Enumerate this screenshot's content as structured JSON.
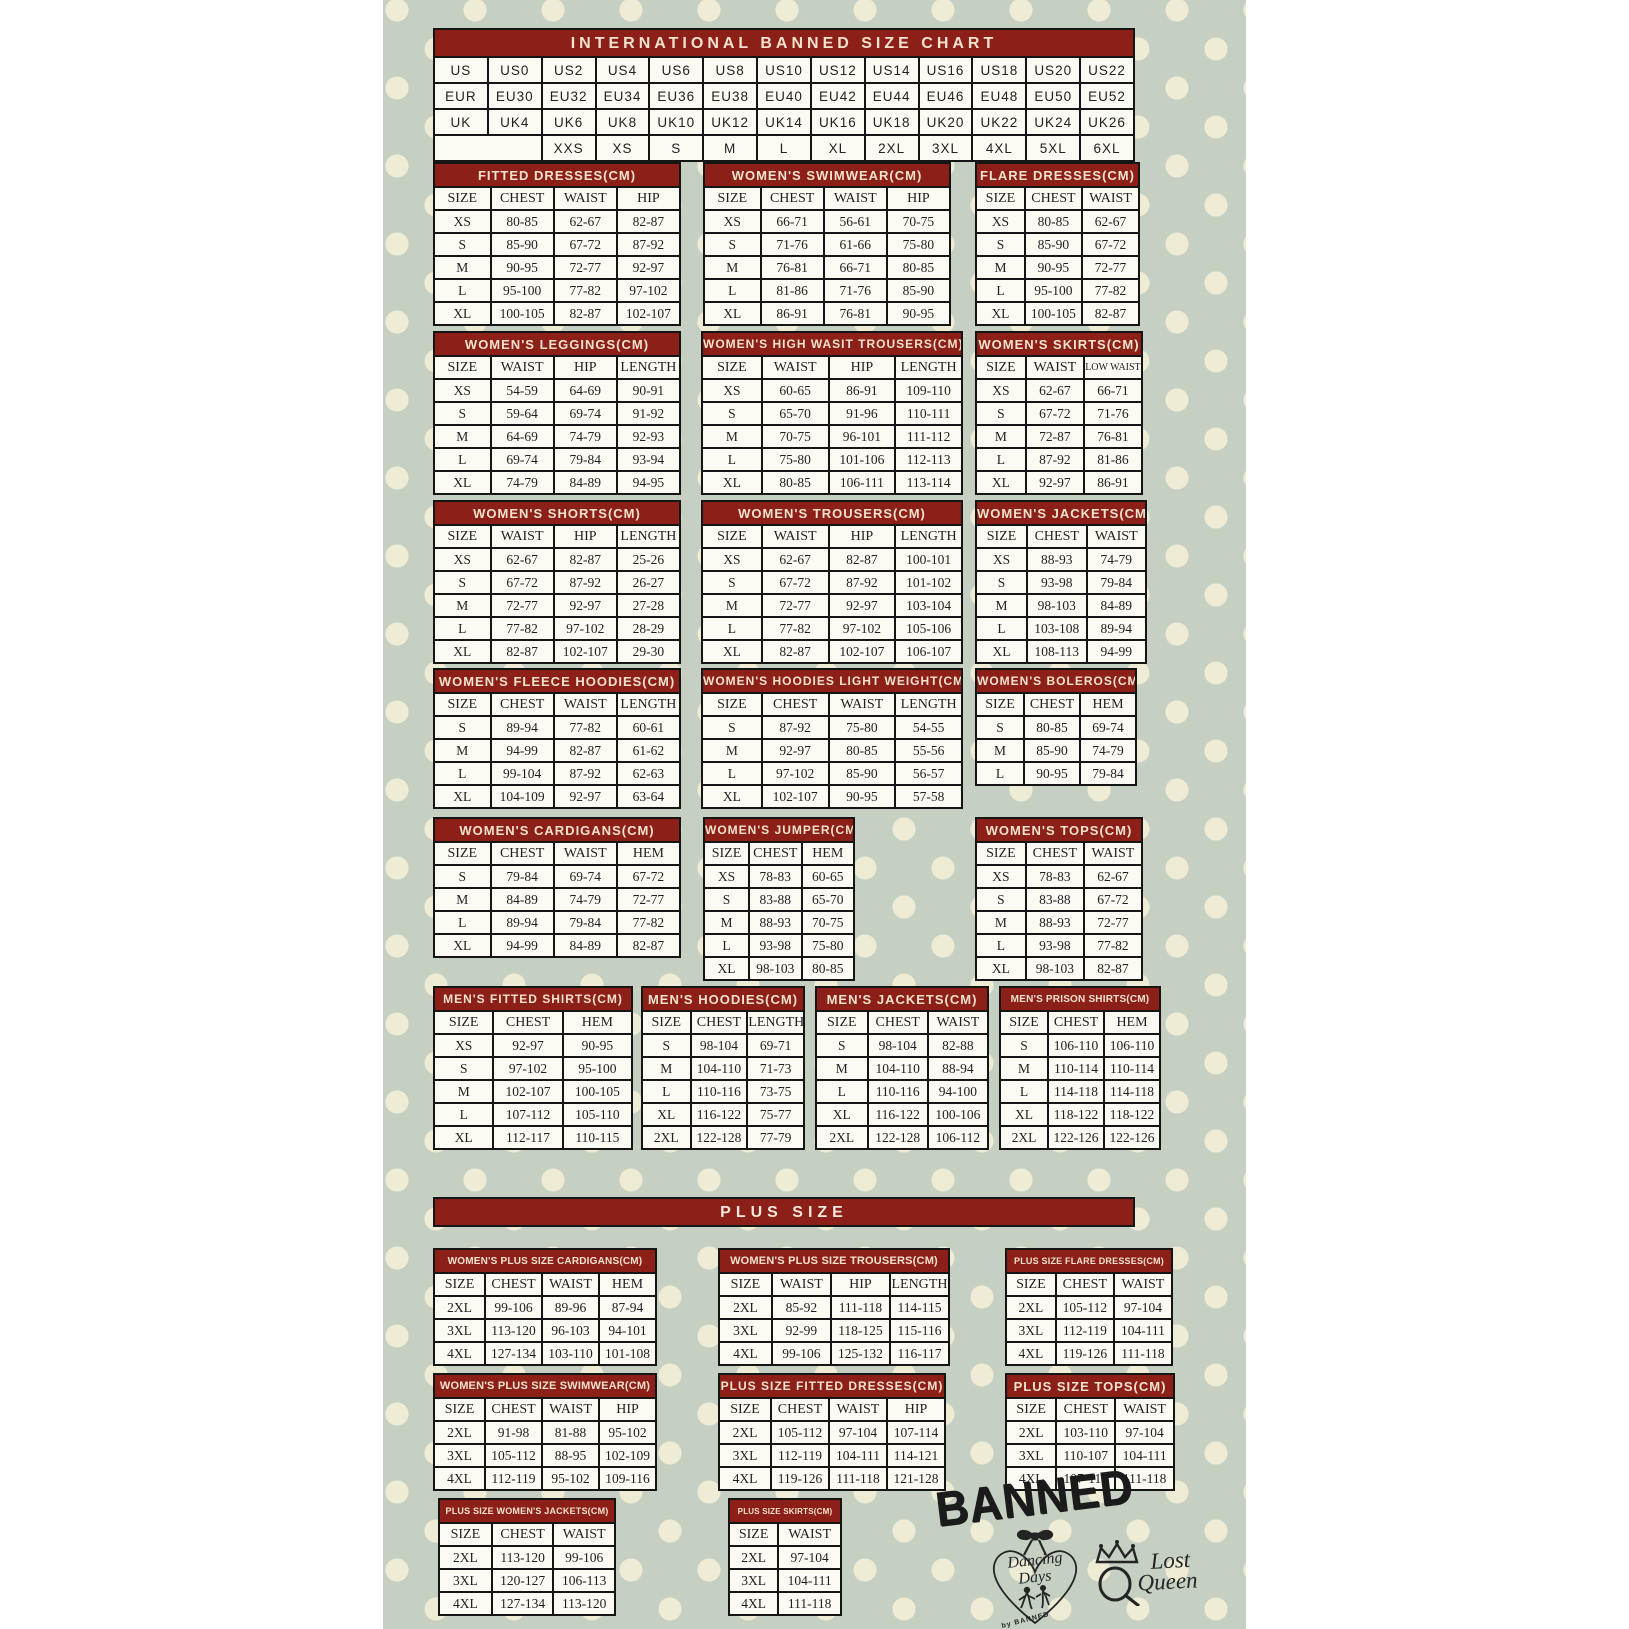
{
  "plus_size_header": "PLUS SIZE",
  "colors": {
    "table_header_red": "#8c1f18",
    "header_text_cream": "#f3e3cd",
    "background_sage": "#c5d0c3",
    "polka_dot_cream": "#efecd6",
    "cell_background": "#fbfaf3",
    "border_black": "#151515",
    "logo_ink": "#242424"
  },
  "conversion_chart": {
    "title": "INTERNATIONAL BANNED SIZE CHART",
    "rows": [
      [
        "US",
        "US0",
        "US2",
        "US4",
        "US6",
        "US8",
        "US10",
        "US12",
        "US14",
        "US16",
        "US18",
        "US20",
        "US22"
      ],
      [
        "EUR",
        "EU30",
        "EU32",
        "EU34",
        "EU36",
        "EU38",
        "EU40",
        "EU42",
        "EU44",
        "EU46",
        "EU48",
        "EU50",
        "EU52"
      ],
      [
        "UK",
        "UK4",
        "UK6",
        "UK8",
        "UK10",
        "UK12",
        "UK14",
        "UK16",
        "UK18",
        "UK20",
        "UK22",
        "UK24",
        "UK26"
      ],
      [
        {
          "text": "",
          "span": 2
        },
        "XXS",
        "XS",
        "S",
        "M",
        "L",
        "XL",
        "2XL",
        "3XL",
        "4XL",
        "5XL",
        "6XL"
      ]
    ]
  },
  "size_tables": {
    "fitted_dresses": {
      "title": "FITTED DRESSES(CM)",
      "headers": [
        "SIZE",
        "CHEST",
        "WAIST",
        "HIP"
      ],
      "rows": [
        [
          "XS",
          "80-85",
          "62-67",
          "82-87"
        ],
        [
          "S",
          "85-90",
          "67-72",
          "87-92"
        ],
        [
          "M",
          "90-95",
          "72-77",
          "92-97"
        ],
        [
          "L",
          "95-100",
          "77-82",
          "97-102"
        ],
        [
          "XL",
          "100-105",
          "82-87",
          "102-107"
        ]
      ]
    },
    "womens_swimwear": {
      "title": "WOMEN'S SWIMWEAR(CM)",
      "headers": [
        "SIZE",
        "CHEST",
        "WAIST",
        "HIP"
      ],
      "rows": [
        [
          "XS",
          "66-71",
          "56-61",
          "70-75"
        ],
        [
          "S",
          "71-76",
          "61-66",
          "75-80"
        ],
        [
          "M",
          "76-81",
          "66-71",
          "80-85"
        ],
        [
          "L",
          "81-86",
          "71-76",
          "85-90"
        ],
        [
          "XL",
          "86-91",
          "76-81",
          "90-95"
        ]
      ]
    },
    "flare_dresses": {
      "title": "FLARE DRESSES(CM)",
      "headers": [
        "SIZE",
        "CHEST",
        "WAIST"
      ],
      "rows": [
        [
          "XS",
          "80-85",
          "62-67"
        ],
        [
          "S",
          "85-90",
          "67-72"
        ],
        [
          "M",
          "90-95",
          "72-77"
        ],
        [
          "L",
          "95-100",
          "77-82"
        ],
        [
          "XL",
          "100-105",
          "82-87"
        ]
      ]
    },
    "womens_leggings": {
      "title": "WOMEN'S LEGGINGS(CM)",
      "headers": [
        "SIZE",
        "WAIST",
        "HIP",
        "LENGTH"
      ],
      "rows": [
        [
          "XS",
          "54-59",
          "64-69",
          "90-91"
        ],
        [
          "S",
          "59-64",
          "69-74",
          "91-92"
        ],
        [
          "M",
          "64-69",
          "74-79",
          "92-93"
        ],
        [
          "L",
          "69-74",
          "79-84",
          "93-94"
        ],
        [
          "XL",
          "74-79",
          "84-89",
          "94-95"
        ]
      ]
    },
    "womens_high_wasit_trousers": {
      "title": "WOMEN'S HIGH WASIT TROUSERS(CM)",
      "headers": [
        "SIZE",
        "WAIST",
        "HIP",
        "LENGTH"
      ],
      "rows": [
        [
          "XS",
          "60-65",
          "86-91",
          "109-110"
        ],
        [
          "S",
          "65-70",
          "91-96",
          "110-111"
        ],
        [
          "M",
          "70-75",
          "96-101",
          "111-112"
        ],
        [
          "L",
          "75-80",
          "101-106",
          "112-113"
        ],
        [
          "XL",
          "80-85",
          "106-111",
          "113-114"
        ]
      ]
    },
    "womens_skirts": {
      "title": "WOMEN'S SKIRTS(CM)",
      "headers": [
        "SIZE",
        "WAIST",
        "LOW WAIST"
      ],
      "rows": [
        [
          "XS",
          "62-67",
          "66-71"
        ],
        [
          "S",
          "67-72",
          "71-76"
        ],
        [
          "M",
          "72-87",
          "76-81"
        ],
        [
          "L",
          "87-92",
          "81-86"
        ],
        [
          "XL",
          "92-97",
          "86-91"
        ]
      ]
    },
    "womens_shorts": {
      "title": "WOMEN'S SHORTS(CM)",
      "headers": [
        "SIZE",
        "WAIST",
        "HIP",
        "LENGTH"
      ],
      "rows": [
        [
          "XS",
          "62-67",
          "82-87",
          "25-26"
        ],
        [
          "S",
          "67-72",
          "87-92",
          "26-27"
        ],
        [
          "M",
          "72-77",
          "92-97",
          "27-28"
        ],
        [
          "L",
          "77-82",
          "97-102",
          "28-29"
        ],
        [
          "XL",
          "82-87",
          "102-107",
          "29-30"
        ]
      ]
    },
    "womens_trousers": {
      "title": "WOMEN'S TROUSERS(CM)",
      "headers": [
        "SIZE",
        "WAIST",
        "HIP",
        "LENGTH"
      ],
      "rows": [
        [
          "XS",
          "62-67",
          "82-87",
          "100-101"
        ],
        [
          "S",
          "67-72",
          "87-92",
          "101-102"
        ],
        [
          "M",
          "72-77",
          "92-97",
          "103-104"
        ],
        [
          "L",
          "77-82",
          "97-102",
          "105-106"
        ],
        [
          "XL",
          "82-87",
          "102-107",
          "106-107"
        ]
      ]
    },
    "womens_jackets": {
      "title": "WOMEN'S JACKETS(CM)",
      "headers": [
        "SIZE",
        "CHEST",
        "WAIST"
      ],
      "rows": [
        [
          "XS",
          "88-93",
          "74-79"
        ],
        [
          "S",
          "93-98",
          "79-84"
        ],
        [
          "M",
          "98-103",
          "84-89"
        ],
        [
          "L",
          "103-108",
          "89-94"
        ],
        [
          "XL",
          "108-113",
          "94-99"
        ]
      ]
    },
    "womens_fleece_hoodies": {
      "title": "WOMEN'S FLEECE HOODIES(CM)",
      "headers": [
        "SIZE",
        "CHEST",
        "WAIST",
        "LENGTH"
      ],
      "rows": [
        [
          "S",
          "89-94",
          "77-82",
          "60-61"
        ],
        [
          "M",
          "94-99",
          "82-87",
          "61-62"
        ],
        [
          "L",
          "99-104",
          "87-92",
          "62-63"
        ],
        [
          "XL",
          "104-109",
          "92-97",
          "63-64"
        ]
      ]
    },
    "womens_hoodies_light_weight": {
      "title": "WOMEN'S HOODIES LIGHT WEIGHT(CM)",
      "headers": [
        "SIZE",
        "CHEST",
        "WAIST",
        "LENGTH"
      ],
      "rows": [
        [
          "S",
          "87-92",
          "75-80",
          "54-55"
        ],
        [
          "M",
          "92-97",
          "80-85",
          "55-56"
        ],
        [
          "L",
          "97-102",
          "85-90",
          "56-57"
        ],
        [
          "XL",
          "102-107",
          "90-95",
          "57-58"
        ]
      ]
    },
    "womens_boleros": {
      "title": "WOMEN'S BOLEROS(CM)",
      "headers": [
        "SIZE",
        "CHEST",
        "HEM"
      ],
      "rows": [
        [
          "S",
          "80-85",
          "69-74"
        ],
        [
          "M",
          "85-90",
          "74-79"
        ],
        [
          "L",
          "90-95",
          "79-84"
        ]
      ]
    },
    "womens_cardigans": {
      "title": "WOMEN'S CARDIGANS(CM)",
      "headers": [
        "SIZE",
        "CHEST",
        "WAIST",
        "HEM"
      ],
      "rows": [
        [
          "S",
          "79-84",
          "69-74",
          "67-72"
        ],
        [
          "M",
          "84-89",
          "74-79",
          "72-77"
        ],
        [
          "L",
          "89-94",
          "79-84",
          "77-82"
        ],
        [
          "XL",
          "94-99",
          "84-89",
          "82-87"
        ]
      ]
    },
    "womens_jumper": {
      "title": "WOMEN'S JUMPER(CM)",
      "headers": [
        "SIZE",
        "CHEST",
        "HEM"
      ],
      "rows": [
        [
          "XS",
          "78-83",
          "60-65"
        ],
        [
          "S",
          "83-88",
          "65-70"
        ],
        [
          "M",
          "88-93",
          "70-75"
        ],
        [
          "L",
          "93-98",
          "75-80"
        ],
        [
          "XL",
          "98-103",
          "80-85"
        ]
      ]
    },
    "womens_tops": {
      "title": "WOMEN'S TOPS(CM)",
      "headers": [
        "SIZE",
        "CHEST",
        "WAIST"
      ],
      "rows": [
        [
          "XS",
          "78-83",
          "62-67"
        ],
        [
          "S",
          "83-88",
          "67-72"
        ],
        [
          "M",
          "88-93",
          "72-77"
        ],
        [
          "L",
          "93-98",
          "77-82"
        ],
        [
          "XL",
          "98-103",
          "82-87"
        ]
      ]
    },
    "mens_fitted_shirts": {
      "title": "MEN'S FITTED SHIRTS(CM)",
      "headers": [
        "SIZE",
        "CHEST",
        "HEM"
      ],
      "rows": [
        [
          "XS",
          "92-97",
          "90-95"
        ],
        [
          "S",
          "97-102",
          "95-100"
        ],
        [
          "M",
          "102-107",
          "100-105"
        ],
        [
          "L",
          "107-112",
          "105-110"
        ],
        [
          "XL",
          "112-117",
          "110-115"
        ]
      ]
    },
    "mens_hoodies": {
      "title": "MEN'S HOODIES(CM)",
      "headers": [
        "SIZE",
        "CHEST",
        "LENGTH"
      ],
      "rows": [
        [
          "S",
          "98-104",
          "69-71"
        ],
        [
          "M",
          "104-110",
          "71-73"
        ],
        [
          "L",
          "110-116",
          "73-75"
        ],
        [
          "XL",
          "116-122",
          "75-77"
        ],
        [
          "2XL",
          "122-128",
          "77-79"
        ]
      ]
    },
    "mens_jackets": {
      "title": "MEN'S JACKETS(CM)",
      "headers": [
        "SIZE",
        "CHEST",
        "WAIST"
      ],
      "rows": [
        [
          "S",
          "98-104",
          "82-88"
        ],
        [
          "M",
          "104-110",
          "88-94"
        ],
        [
          "L",
          "110-116",
          "94-100"
        ],
        [
          "XL",
          "116-122",
          "100-106"
        ],
        [
          "2XL",
          "122-128",
          "106-112"
        ]
      ]
    },
    "mens_prison_shirts": {
      "title": "MEN'S PRISON SHIRTS(CM)",
      "headers": [
        "SIZE",
        "CHEST",
        "HEM"
      ],
      "rows": [
        [
          "S",
          "106-110",
          "106-110"
        ],
        [
          "M",
          "110-114",
          "110-114"
        ],
        [
          "L",
          "114-118",
          "114-118"
        ],
        [
          "XL",
          "118-122",
          "118-122"
        ],
        [
          "2XL",
          "122-126",
          "122-126"
        ]
      ]
    },
    "womens_plus_size_cardigans": {
      "title": "WOMEN'S PLUS SIZE CARDIGANS(CM)",
      "headers": [
        "SIZE",
        "CHEST",
        "WAIST",
        "HEM"
      ],
      "rows": [
        [
          "2XL",
          "99-106",
          "89-96",
          "87-94"
        ],
        [
          "3XL",
          "113-120",
          "96-103",
          "94-101"
        ],
        [
          "4XL",
          "127-134",
          "103-110",
          "101-108"
        ]
      ]
    },
    "womens_plus_size_trousers": {
      "title": "WOMEN'S PLUS SIZE TROUSERS(CM)",
      "headers": [
        "SIZE",
        "WAIST",
        "HIP",
        "LENGTH"
      ],
      "rows": [
        [
          "2XL",
          "85-92",
          "111-118",
          "114-115"
        ],
        [
          "3XL",
          "92-99",
          "118-125",
          "115-116"
        ],
        [
          "4XL",
          "99-106",
          "125-132",
          "116-117"
        ]
      ]
    },
    "plus_size_flare_dresses": {
      "title": "PLUS SIZE FLARE DRESSES(CM)",
      "headers": [
        "SIZE",
        "CHEST",
        "WAIST"
      ],
      "rows": [
        [
          "2XL",
          "105-112",
          "97-104"
        ],
        [
          "3XL",
          "112-119",
          "104-111"
        ],
        [
          "4XL",
          "119-126",
          "111-118"
        ]
      ]
    },
    "womens_plus_size_swimwear": {
      "title": "WOMEN'S PLUS SIZE SWIMWEAR(CM)",
      "headers": [
        "SIZE",
        "CHEST",
        "WAIST",
        "HIP"
      ],
      "rows": [
        [
          "2XL",
          "91-98",
          "81-88",
          "95-102"
        ],
        [
          "3XL",
          "105-112",
          "88-95",
          "102-109"
        ],
        [
          "4XL",
          "112-119",
          "95-102",
          "109-116"
        ]
      ]
    },
    "plus_size_fitted_dresses": {
      "title": "PLUS SIZE FITTED DRESSES(CM)",
      "headers": [
        "SIZE",
        "CHEST",
        "WAIST",
        "HIP"
      ],
      "rows": [
        [
          "2XL",
          "105-112",
          "97-104",
          "107-114"
        ],
        [
          "3XL",
          "112-119",
          "104-111",
          "114-121"
        ],
        [
          "4XL",
          "119-126",
          "111-118",
          "121-128"
        ]
      ]
    },
    "plus_size_tops": {
      "title": "PLUS SIZE TOPS(CM)",
      "headers": [
        "SIZE",
        "CHEST",
        "WAIST"
      ],
      "rows": [
        [
          "2XL",
          "103-110",
          "97-104"
        ],
        [
          "3XL",
          "110-107",
          "104-111"
        ],
        [
          "4XL",
          "107-114",
          "111-118"
        ]
      ]
    },
    "plus_size_womens_jackets": {
      "title": "PLUS SIZE WOMEN'S JACKETS(CM)",
      "headers": [
        "SIZE",
        "CHEST",
        "WAIST"
      ],
      "rows": [
        [
          "2XL",
          "113-120",
          "99-106"
        ],
        [
          "3XL",
          "120-127",
          "106-113"
        ],
        [
          "4XL",
          "127-134",
          "113-120"
        ]
      ]
    },
    "plus_size_skirts": {
      "title": "PLUS SIZE SKIRTS(CM)",
      "headers": [
        "SIZE",
        "WAIST"
      ],
      "rows": [
        [
          "2XL",
          "97-104"
        ],
        [
          "3XL",
          "104-111"
        ],
        [
          "4XL",
          "111-118"
        ]
      ]
    }
  },
  "logos": {
    "banned": "BANNED",
    "dancing_days_line1": "Dancing",
    "dancing_days_line2": "Days",
    "dancing_days_sub": "by BANNED",
    "lost_queen_line1": "Lost",
    "lost_queen_line2": "Queen"
  }
}
